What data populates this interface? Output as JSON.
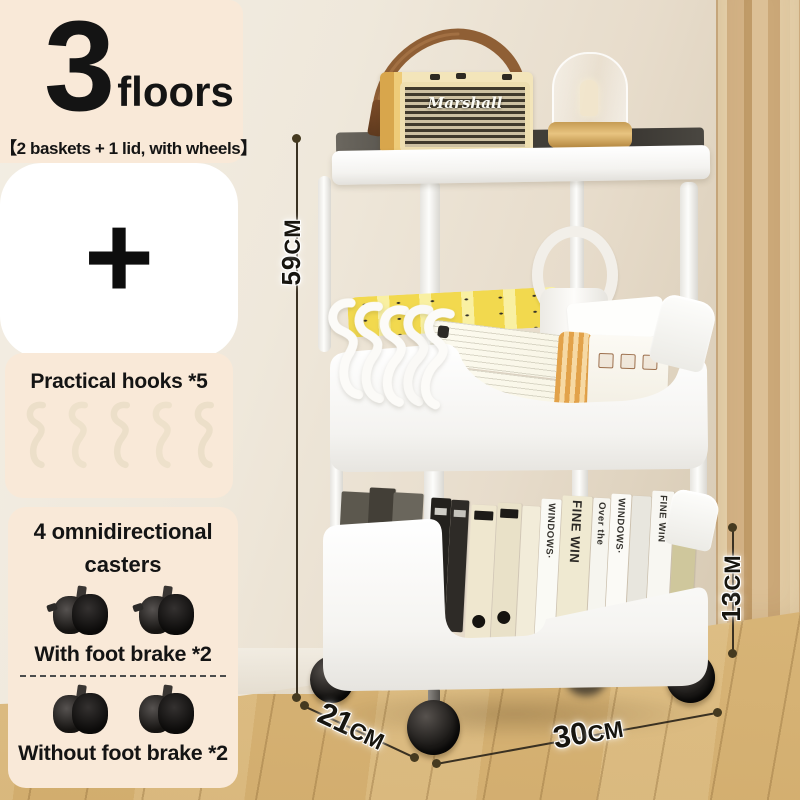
{
  "panel_top": {
    "number": "3",
    "unit": "floors",
    "subtitle": "【2 baskets + 1 lid, with wheels】"
  },
  "panel_plus": {
    "plus": "+"
  },
  "panel_hooks": {
    "title": "Practical hooks *5",
    "hook_count": 5
  },
  "panel_casters": {
    "title_line1": "4 omnidirectional",
    "title_line2": "casters",
    "with_brake": "With foot brake *2",
    "without_brake": "Without foot brake *2"
  },
  "dimensions": {
    "height": {
      "value": "59",
      "unit": "CM"
    },
    "basket_height": {
      "value": "13",
      "unit": "CM"
    },
    "depth": {
      "value": "21",
      "unit": "CM"
    },
    "width": {
      "value": "30",
      "unit": "CM"
    }
  },
  "cart": {
    "speaker_brand": "Marshall",
    "books": [
      {
        "label": "WINDOWS·"
      },
      {
        "label": "FINE WIN"
      },
      {
        "label": "Over the"
      },
      {
        "label": "WINDOWS·"
      },
      {
        "label": "FINE WIN"
      },
      {
        "label": "1000"
      }
    ]
  },
  "colors": {
    "panel_bg": "#f9e9d8",
    "wall": "#ece3d4",
    "curtain": "#d3b285",
    "floor": "#d9b87e",
    "cart_white": "#fafaf8",
    "pack_yellow": "#f2d94e",
    "dimension_line": "#3a3122",
    "text": "#141414"
  }
}
